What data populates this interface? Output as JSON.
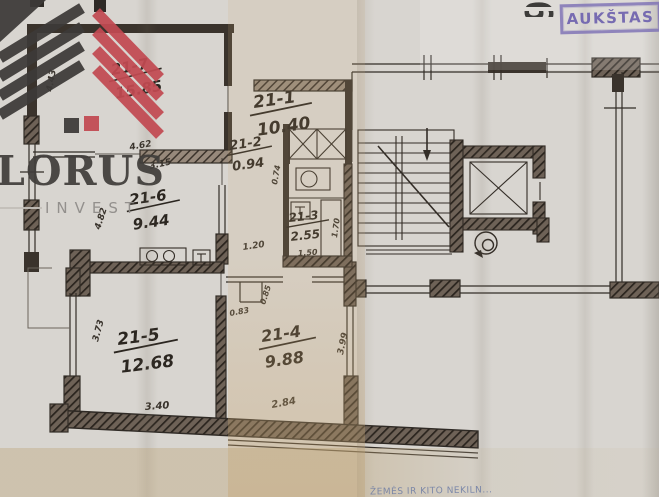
{
  "logo": {
    "brand": "LORUS",
    "tagline": "INVEST"
  },
  "stamp": {
    "floor_number": "6",
    "floor_label": "AUKŠTAS"
  },
  "footer": {
    "faint_stamp_text": "ŽEMĖS IR KITO NEKILN..."
  },
  "plan": {
    "rooms": [
      {
        "id": "21-7",
        "area": "15.85"
      },
      {
        "id": "21-1",
        "area": "10.40"
      },
      {
        "id": "21-2",
        "area": "0.94"
      },
      {
        "id": "21-3",
        "area": "2.55"
      },
      {
        "id": "21-6",
        "area": "9.44"
      },
      {
        "id": "21-5",
        "area": "12.68"
      },
      {
        "id": "21-4",
        "area": "9.88"
      }
    ],
    "dimensions": [
      "4.43",
      "4.62",
      "3.15",
      "4.82",
      "1.20",
      "0.74",
      "1.50",
      "1.70",
      "3.73",
      "3.40",
      "2.84",
      "3.99",
      "0.83",
      "0.85"
    ],
    "icons": [
      "staircase-icon",
      "elevator-icon",
      "garbage-chute-icon",
      "vent-shaft-icon",
      "toilet-icon",
      "sink-icon",
      "stove-icon",
      "wardrobe-icon",
      "balcony-icon"
    ],
    "colors": {
      "ink": "#332d27",
      "stamp_purple": "#7b6eb4",
      "logo_dark": "#3d3a38",
      "logo_red": "#c24a52",
      "paper": "#d8d5d0"
    }
  }
}
